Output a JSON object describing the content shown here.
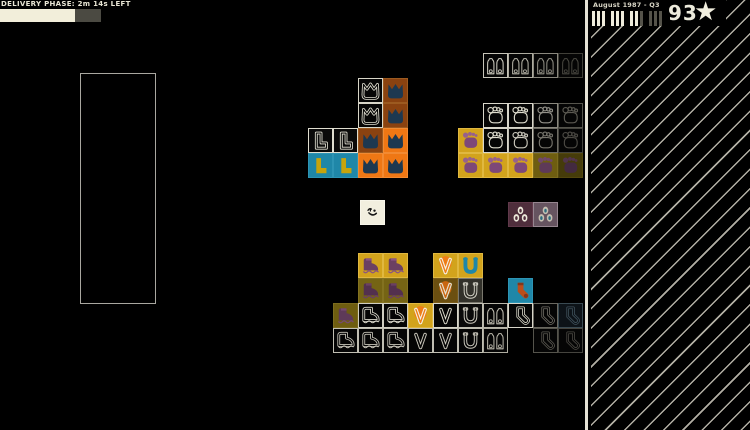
{
  "hud": {
    "phase_label": "DELIVERY PHASE:  2m 14s LEFT",
    "timer": {
      "fill_px": 75,
      "rest_px": 26,
      "fill_color": "#f2eeda",
      "rest_color": "#4b4a42"
    },
    "quarter_label": "August 1987 - Q3",
    "quarter_bars": {
      "total": 12,
      "filled": 8,
      "group_size": 3,
      "filled_color": "#efecdc",
      "empty_color": "#55534a"
    },
    "score": "93",
    "star_glyph": "★"
  },
  "board": {
    "tile_size": 25,
    "storage_zone": {
      "x": 80,
      "y": 73,
      "w": 76,
      "h": 231
    },
    "player": {
      "x": 360,
      "y": 200,
      "bg": "#f2efdf",
      "bd": "#f8f6ea",
      "icon": "wink-face",
      "mode": "duo",
      "c1": "#161616",
      "c2": "#161616"
    },
    "tiles": [
      {
        "x": 358,
        "y": 78,
        "bg": "#060606",
        "bd": "#d8d6c8",
        "icon": "flipper",
        "mode": "outline",
        "c1": "#e2e0d2"
      },
      {
        "x": 383,
        "y": 78,
        "bg": "#8a4210",
        "bd": "#9c5a20",
        "icon": "flipper",
        "mode": "solid",
        "c1": "#1d3850"
      },
      {
        "x": 358,
        "y": 103,
        "bg": "#060606",
        "bd": "#d8d6c8",
        "icon": "flipper",
        "mode": "outline",
        "c1": "#e2e0d2"
      },
      {
        "x": 383,
        "y": 103,
        "bg": "#8a4210",
        "bd": "#9c5a20",
        "icon": "flipper",
        "mode": "solid",
        "c1": "#1d3850"
      },
      {
        "x": 308,
        "y": 128,
        "bg": "#0a0a0a",
        "bd": "#e0ded0",
        "icon": "boot-l",
        "mode": "outline",
        "c1": "#e4e2d4"
      },
      {
        "x": 333,
        "y": 128,
        "bg": "#0a0a0a",
        "bd": "#e0ded0",
        "icon": "boot-l",
        "mode": "outline",
        "c1": "#e4e2d4"
      },
      {
        "x": 358,
        "y": 128,
        "bg": "#8a4210",
        "bd": "#9c5a20",
        "icon": "flipper",
        "mode": "solid",
        "c1": "#1d3850"
      },
      {
        "x": 383,
        "y": 128,
        "bg": "#ef7714",
        "bd": "#f28a32",
        "icon": "flipper",
        "mode": "solid",
        "c1": "#1d3850"
      },
      {
        "x": 308,
        "y": 153,
        "bg": "#1f87a8",
        "bd": "#2d94b4",
        "icon": "boot-l",
        "mode": "solid",
        "c1": "#c7a40c"
      },
      {
        "x": 333,
        "y": 153,
        "bg": "#1f87a8",
        "bd": "#2d94b4",
        "icon": "boot-l",
        "mode": "solid",
        "c1": "#c7a40c"
      },
      {
        "x": 358,
        "y": 153,
        "bg": "#ef7714",
        "bd": "#f28a32",
        "icon": "flipper",
        "mode": "solid",
        "c1": "#1d3850"
      },
      {
        "x": 383,
        "y": 153,
        "bg": "#ef7714",
        "bd": "#f28a32",
        "icon": "flipper",
        "mode": "solid",
        "c1": "#1d3850"
      },
      {
        "x": 483,
        "y": 53,
        "bg": "#050505",
        "bd": "#c6c4b8",
        "icon": "claw",
        "mode": "outline",
        "c1": "#ceccc0"
      },
      {
        "x": 508,
        "y": 53,
        "bg": "#050505",
        "bd": "#aeac a0",
        "icon": "claw",
        "mode": "outline",
        "c1": "#b2b0a4"
      },
      {
        "x": 533,
        "y": 53,
        "bg": "#050505",
        "bd": "#8a887e",
        "icon": "claw",
        "mode": "outline",
        "c1": "#8e8c82"
      },
      {
        "x": 558,
        "y": 53,
        "bg": "#050505",
        "bd": "#403f38",
        "icon": "claw",
        "mode": "outline",
        "c1": "#46453e"
      },
      {
        "x": 483,
        "y": 103,
        "bg": "#050505",
        "bd": "#d8d6ca",
        "icon": "foot",
        "mode": "outline",
        "c1": "#e0decf"
      },
      {
        "x": 508,
        "y": 103,
        "bg": "#050505",
        "bd": "#d8d6ca",
        "icon": "foot",
        "mode": "outline",
        "c1": "#e0decf"
      },
      {
        "x": 533,
        "y": 103,
        "bg": "#050505",
        "bd": "#8a887e",
        "icon": "foot",
        "mode": "outline",
        "c1": "#94928a"
      },
      {
        "x": 558,
        "y": 103,
        "bg": "#050505",
        "bd": "#55544c",
        "icon": "foot",
        "mode": "outline",
        "c1": "#5c5a52"
      },
      {
        "x": 458,
        "y": 128,
        "bg": "#d2a31c",
        "bd": "#e0b840",
        "icon": "foot",
        "mode": "duo",
        "c1": "#7d4878",
        "c2": "#96618c"
      },
      {
        "x": 483,
        "y": 128,
        "bg": "#050505",
        "bd": "#d8d6ca",
        "icon": "foot",
        "mode": "outline",
        "c1": "#e0decf"
      },
      {
        "x": 508,
        "y": 128,
        "bg": "#050505",
        "bd": "#c4c2b6",
        "icon": "foot",
        "mode": "outline",
        "c1": "#ccc9bd"
      },
      {
        "x": 533,
        "y": 128,
        "bg": "#050505",
        "bd": "#6e6c64",
        "icon": "foot",
        "mode": "outline",
        "c1": "#76746c"
      },
      {
        "x": 558,
        "y": 128,
        "bg": "#050505",
        "bd": "#45443e",
        "icon": "foot",
        "mode": "outline",
        "c1": "#4c4a44"
      },
      {
        "x": 458,
        "y": 153,
        "bg": "#d2a31c",
        "bd": "#e0b840",
        "icon": "foot",
        "mode": "duo",
        "c1": "#7d4878",
        "c2": "#96618c"
      },
      {
        "x": 483,
        "y": 153,
        "bg": "#d2a31c",
        "bd": "#e0b840",
        "icon": "foot",
        "mode": "duo",
        "c1": "#7d4878",
        "c2": "#96618c"
      },
      {
        "x": 508,
        "y": 153,
        "bg": "#d2a31c",
        "bd": "#e0b840",
        "icon": "foot",
        "mode": "duo",
        "c1": "#7d4878",
        "c2": "#96618c"
      },
      {
        "x": 533,
        "y": 153,
        "bg": "#6e5d10",
        "bd": "#7c6c1e",
        "icon": "foot",
        "mode": "duo",
        "c1": "#5e3a58",
        "c2": "#70486a"
      },
      {
        "x": 558,
        "y": 153,
        "bg": "#453b0a",
        "bd": "#52470e",
        "icon": "foot",
        "mode": "duo",
        "c1": "#432a40",
        "c2": "#51344c"
      },
      {
        "x": 508,
        "y": 202,
        "bg": "#4f2e3c",
        "bd": "#60394a",
        "icon": "eyes",
        "mode": "duo",
        "c1": "#ece8da",
        "c2": "#4f2e3c"
      },
      {
        "x": 533,
        "y": 202,
        "bg": "#665460",
        "bd": "#968690",
        "icon": "eyes",
        "mode": "duo",
        "c1": "#c6c0b2",
        "c2": "#2e6e80"
      },
      {
        "x": 358,
        "y": 253,
        "bg": "#d2a31c",
        "bd": "#e0b840",
        "icon": "hiking-boot",
        "mode": "duo",
        "c1": "#6b4062",
        "c2": "#8a5580"
      },
      {
        "x": 383,
        "y": 253,
        "bg": "#d2a31c",
        "bd": "#e0b840",
        "icon": "hiking-boot",
        "mode": "duo",
        "c1": "#6b4062",
        "c2": "#8a5580"
      },
      {
        "x": 433,
        "y": 253,
        "bg": "#d2a31c",
        "bd": "#e0b840",
        "icon": "v-disc",
        "mode": "duo",
        "c1": "#ee7d18",
        "c2": "#f4f0e2"
      },
      {
        "x": 458,
        "y": 253,
        "bg": "#d2a31c",
        "bd": "#e0b840",
        "icon": "horseshoe",
        "mode": "solid",
        "c1": "#1f87a8"
      },
      {
        "x": 358,
        "y": 278,
        "bg": "#756414",
        "bd": "#837220",
        "icon": "hiking-boot",
        "mode": "duo",
        "c1": "#53304e",
        "c2": "#6b4062"
      },
      {
        "x": 383,
        "y": 278,
        "bg": "#756414",
        "bd": "#837220",
        "icon": "hiking-boot",
        "mode": "duo",
        "c1": "#53304e",
        "c2": "#6b4062"
      },
      {
        "x": 433,
        "y": 278,
        "bg": "#6b4f10",
        "bd": "#7a5c1a",
        "icon": "v-disc",
        "mode": "duo",
        "c1": "#c9660f",
        "c2": "#e6e2d0"
      },
      {
        "x": 458,
        "y": 278,
        "bg": "#32312a",
        "bd": "#7a786e",
        "icon": "horseshoe",
        "mode": "outline",
        "c1": "#d4d2c6"
      },
      {
        "x": 508,
        "y": 278,
        "bg": "#1f87a8",
        "bd": "#2d94b4",
        "icon": "sock",
        "mode": "duo",
        "c1": "#bc4e1a",
        "c2": "#84361a"
      },
      {
        "x": 333,
        "y": 303,
        "bg": "#6e5d10",
        "bd": "#7c6c1e",
        "icon": "hiking-boot",
        "mode": "duo",
        "c1": "#5e3a58",
        "c2": "#764a6e"
      },
      {
        "x": 358,
        "y": 303,
        "bg": "#050505",
        "bd": "#d0cec2",
        "icon": "hiking-boot",
        "mode": "outline",
        "c1": "#dcdacd"
      },
      {
        "x": 383,
        "y": 303,
        "bg": "#050505",
        "bd": "#d0cec2",
        "icon": "hiking-boot",
        "mode": "outline",
        "c1": "#dcdacd"
      },
      {
        "x": 408,
        "y": 303,
        "bg": "#d2a31c",
        "bd": "#e0b840",
        "icon": "v-disc",
        "mode": "duo",
        "c1": "#ee7d18",
        "c2": "#f4f0e2"
      },
      {
        "x": 433,
        "y": 303,
        "bg": "#050505",
        "bd": "#d8d6ca",
        "icon": "v",
        "mode": "outline",
        "c1": "#e0decf"
      },
      {
        "x": 458,
        "y": 303,
        "bg": "#0a0a0a",
        "bd": "#c0beb2",
        "icon": "horseshoe",
        "mode": "outline",
        "c1": "#ccc9bd"
      },
      {
        "x": 483,
        "y": 303,
        "bg": "#050505",
        "bd": "#b8b6aa",
        "icon": "claw",
        "mode": "outline",
        "c1": "#c0bdb1"
      },
      {
        "x": 508,
        "y": 303,
        "bg": "#050505",
        "bd": "#d8d6ca",
        "icon": "sock",
        "mode": "outline",
        "c1": "#e0decf"
      },
      {
        "x": 533,
        "y": 303,
        "bg": "#050505",
        "bd": "#6a6860",
        "icon": "sock",
        "mode": "outline",
        "c1": "#726f67"
      },
      {
        "x": 558,
        "y": 303,
        "bg": "#0d1318",
        "bd": "#3a4a52",
        "icon": "sock",
        "mode": "outline",
        "c1": "#40525c"
      },
      {
        "x": 333,
        "y": 328,
        "bg": "#050505",
        "bd": "#c0beb2",
        "icon": "hiking-boot",
        "mode": "outline",
        "c1": "#c9c6ba"
      },
      {
        "x": 358,
        "y": 328,
        "bg": "#050505",
        "bd": "#c0beb2",
        "icon": "hiking-boot",
        "mode": "outline",
        "c1": "#c9c6ba"
      },
      {
        "x": 383,
        "y": 328,
        "bg": "#050505",
        "bd": "#c0beb2",
        "icon": "hiking-boot",
        "mode": "outline",
        "c1": "#c9c6ba"
      },
      {
        "x": 408,
        "y": 328,
        "bg": "#050505",
        "bd": "#c0beb2",
        "icon": "v",
        "mode": "outline",
        "c1": "#c9c6ba"
      },
      {
        "x": 433,
        "y": 328,
        "bg": "#050505",
        "bd": "#c0beb2",
        "icon": "v",
        "mode": "outline",
        "c1": "#c9c6ba"
      },
      {
        "x": 458,
        "y": 328,
        "bg": "#050505",
        "bd": "#c0beb2",
        "icon": "horseshoe",
        "mode": "outline",
        "c1": "#c9c6ba"
      },
      {
        "x": 483,
        "y": 328,
        "bg": "#050505",
        "bd": "#aeaca0",
        "icon": "claw",
        "mode": "outline",
        "c1": "#b6b3a7"
      },
      {
        "x": 533,
        "y": 328,
        "bg": "#050505",
        "bd": "#55544c",
        "icon": "sock",
        "mode": "outline",
        "c1": "#5c5a52"
      },
      {
        "x": 558,
        "y": 328,
        "bg": "#050505",
        "bd": "#45443e",
        "icon": "sock",
        "mode": "outline",
        "c1": "#4c4a44"
      }
    ]
  }
}
